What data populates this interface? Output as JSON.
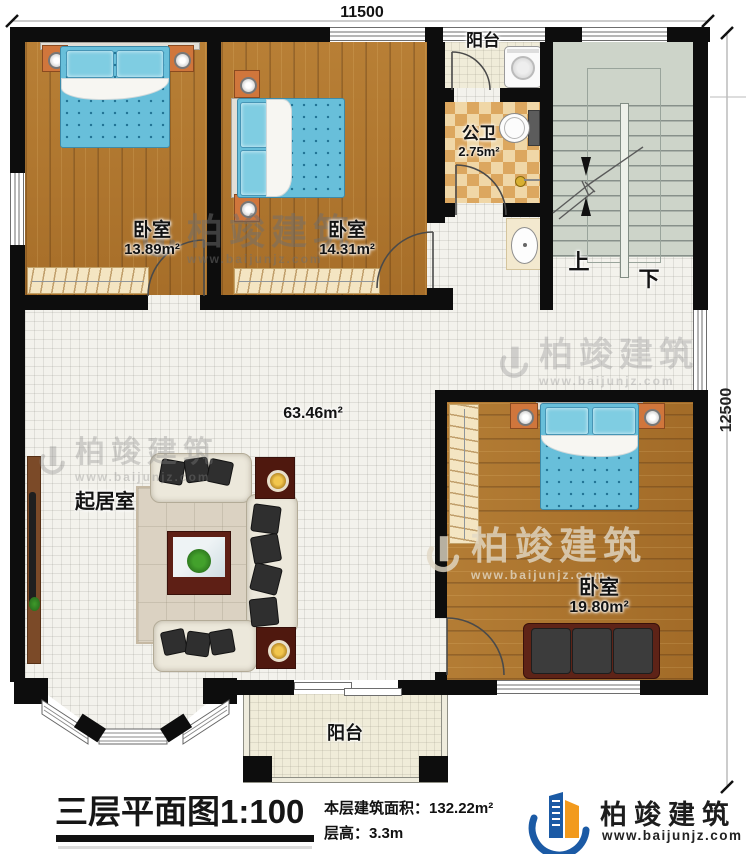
{
  "plan": {
    "dim_top": "11500",
    "dim_right": "12500",
    "bedroom1": {
      "name": "卧室",
      "area": "13.89m²"
    },
    "bedroom2": {
      "name": "卧室",
      "area": "14.31m²"
    },
    "bedroom3": {
      "name": "卧室",
      "area": "19.80m²"
    },
    "bathroom": {
      "name": "公卫",
      "area": "2.75m²"
    },
    "balcony_top": {
      "name": "阳台"
    },
    "balcony_bottom": {
      "name": "阳台"
    },
    "living_room": {
      "name": "起居室",
      "area": "63.46m²"
    },
    "stairs": {
      "up": "上",
      "down": "下"
    }
  },
  "titleblock": {
    "title": "三层平面图1:100",
    "area_label": "本层建筑面积：",
    "area_value": "132.22m²",
    "floor_height_label": "层高：",
    "floor_height_value": "3.3m"
  },
  "brand": {
    "name": "柏竣建筑",
    "website": "www.baijunjz.com"
  },
  "watermark": {
    "name": "柏竣建筑",
    "website": "www.baijunjz.com"
  },
  "colors": {
    "wall": "#0d0d0d",
    "wood_floor": "#b0772e",
    "tile_floor": "#f3f2ec",
    "bath_tile": "#dca75f",
    "stair_floor": "#cdd4c9",
    "bed_blue": "#68bfda",
    "nightstand_orange": "#d0763c",
    "logo_blue": "#1b5aa5",
    "logo_orange": "#f29a1d"
  }
}
